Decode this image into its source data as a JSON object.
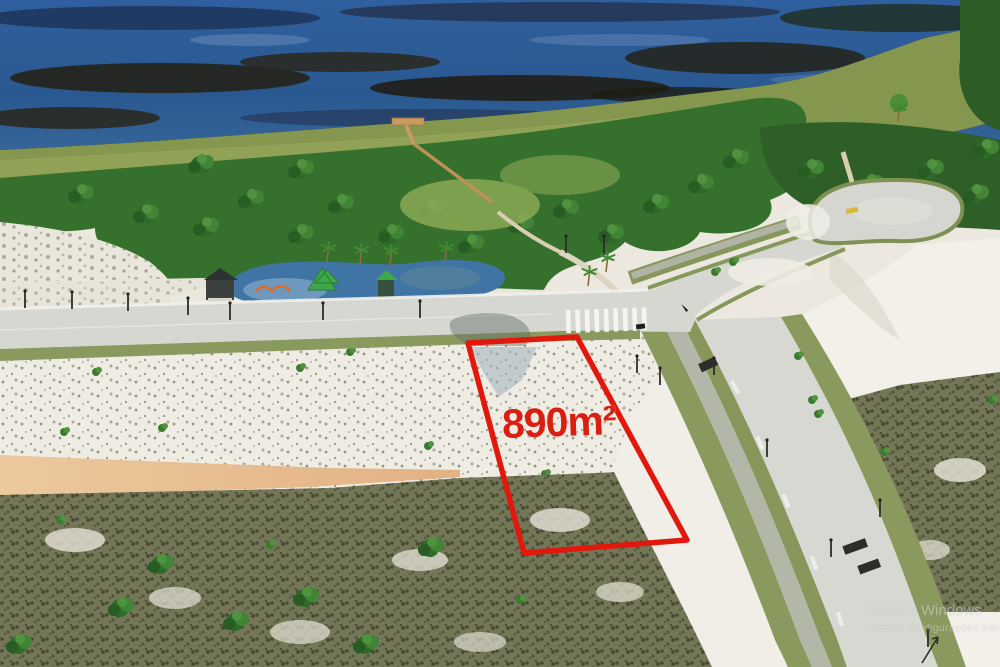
{
  "annotation": {
    "area_label": "890m²",
    "outline_color": "#e2180c",
    "label_color": "#d91f12"
  },
  "watermark": {
    "line1": "Ativar o Windows",
    "line2": "Acesse Configurações para ativar o Windows."
  },
  "scene": {
    "type": "aerial-drone-photo",
    "elements": [
      "lagoon",
      "marsh",
      "forest-band",
      "wooden-boardwalk",
      "playground",
      "gazebo",
      "main-street",
      "side-street",
      "bike-path",
      "cul-de-sac-loop",
      "crosswalk",
      "street-lamps",
      "white-sand-field",
      "orange-sand-band",
      "scrubland",
      "dunes",
      "palm-trees",
      "lot-outline-890m2"
    ],
    "colors": {
      "water": "#2a5a96",
      "marsh": "#231f12",
      "forest": "#35702c",
      "road": "#d7d8d2",
      "bike_path": "#b3b7a7",
      "grass_verge": "#8a9a5f",
      "sand": "#efece4",
      "orange_sand": "#e7bd8f",
      "scrub": "#737657"
    }
  }
}
